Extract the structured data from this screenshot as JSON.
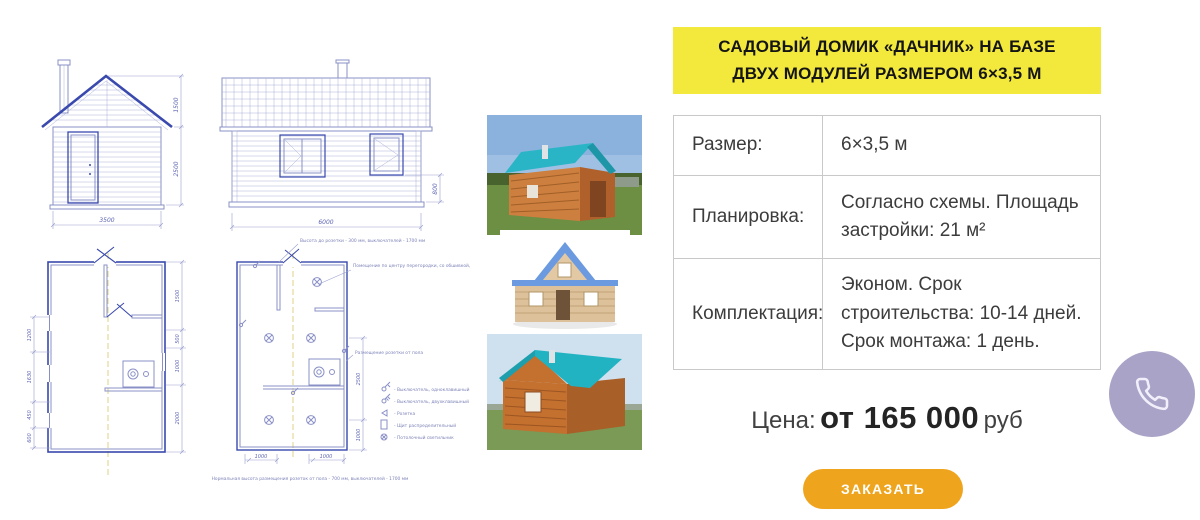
{
  "panel": {
    "title": "САДОВЫЙ ДОМИК «ДАЧНИК» НА БАЗЕ ДВУХ МОДУЛЕЙ РАЗМЕРОМ 6×3,5 М",
    "table": {
      "rows": [
        {
          "label": "Размер:",
          "value": "6×3,5 м"
        },
        {
          "label": "Планировка:",
          "value": "Согласно схемы. Площадь застройки: 21 м²"
        },
        {
          "label": "Комплектация:",
          "value": "Эконом. Срок строительства: 10-14 дней. Срок монтажа: 1 день."
        }
      ]
    },
    "price": {
      "label": "Цена:",
      "amount": "от 165 000",
      "currency": "руб"
    },
    "order_button": "ЗАКАЗАТЬ",
    "phone_button_icon": "phone-icon"
  },
  "colors": {
    "banner_yellow": "#F2E93C",
    "button_orange": "#EFA41E",
    "phone_lavender": "#A9A3C8",
    "blueprint_blue": "#3949AD",
    "roof_teal": "#2AB5C6"
  },
  "drawings": {
    "front_elevation": {
      "dims": [
        "1500",
        "2500",
        "3500"
      ]
    },
    "side_elevation": {
      "dims": [
        "6000",
        "800"
      ]
    },
    "floor_plan": {
      "left_dims": [
        "1200",
        "1630",
        "450",
        "600"
      ],
      "right_dims": [
        "1500",
        "500",
        "1000",
        "2000"
      ]
    },
    "electric_plan": {
      "right_dims": [
        "2500",
        "1000"
      ],
      "bottom_dims": [
        "1000",
        "1000"
      ],
      "note_top": "Высота до розетки - 300 мм, выключателей - 1700 мм",
      "note_right": "Помещение по центру перегородки, со обшивкой, с двумя отдельными дверями",
      "note_mid": "Размещение розетки от пола",
      "caption": "Нормальная высота размещения розеток от пола - 700 мм, выключателей - 1700 мм",
      "legend": [
        {
          "icon": "switch-single-icon",
          "label": "- Выключатель, одноклавишный"
        },
        {
          "icon": "switch-double-icon",
          "label": "- Выключатель, двухклавишный"
        },
        {
          "icon": "socket-icon",
          "label": "- Розетка"
        },
        {
          "icon": "panel-icon",
          "label": "- Щит распределительный"
        },
        {
          "icon": "ceiling-light-icon",
          "label": "- Потолочный светильник"
        }
      ]
    }
  }
}
